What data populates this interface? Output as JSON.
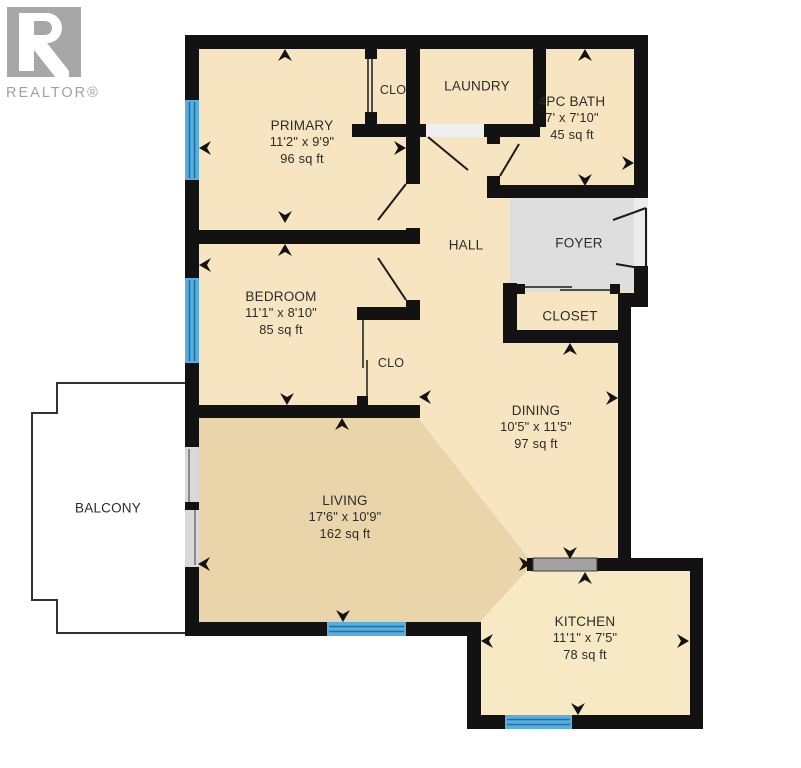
{
  "brand": {
    "logo_text": "REALTOR®",
    "logo_letter": "R"
  },
  "rooms": {
    "primary": {
      "name": "PRIMARY",
      "dims": "11'2\" x 9'9\"",
      "area": "96 sq ft"
    },
    "primary_closet": {
      "name": "CLO"
    },
    "laundry": {
      "name": "LAUNDRY"
    },
    "bath": {
      "name": "4PC BATH",
      "dims": "7' x 7'10\"",
      "area": "45 sq ft"
    },
    "hall": {
      "name": "HALL"
    },
    "foyer": {
      "name": "FOYER"
    },
    "closet": {
      "name": "CLOSET"
    },
    "bedroom": {
      "name": "BEDROOM",
      "dims": "11'1\" x 8'10\"",
      "area": "85 sq ft"
    },
    "bedroom_closet": {
      "name": "CLO"
    },
    "dining": {
      "name": "DINING",
      "dims": "10'5\" x 11'5\"",
      "area": "97 sq ft"
    },
    "living": {
      "name": "LIVING",
      "dims": "17'6\" x 10'9\"",
      "area": "162 sq ft"
    },
    "balcony": {
      "name": "BALCONY"
    },
    "kitchen": {
      "name": "KITCHEN",
      "dims": "11'1\" x 7'5\"",
      "area": "78 sq ft"
    }
  },
  "colors": {
    "wall": "#121212",
    "floor_cream": "#F7E5C1",
    "floor_dark": "#EAD5AB",
    "kitchen_floor": "#F8E9C5",
    "foyer_gray": "#DEDEDE",
    "window_blue": "#58AEDD",
    "window_line": "#1F6FA8",
    "counter_gray": "#A2A2A2",
    "door_line": "#1a1a1a",
    "balcony_outline": "#333333",
    "slider_gray": "#D9D9D9",
    "logo_gray": "#A7A7A7"
  }
}
